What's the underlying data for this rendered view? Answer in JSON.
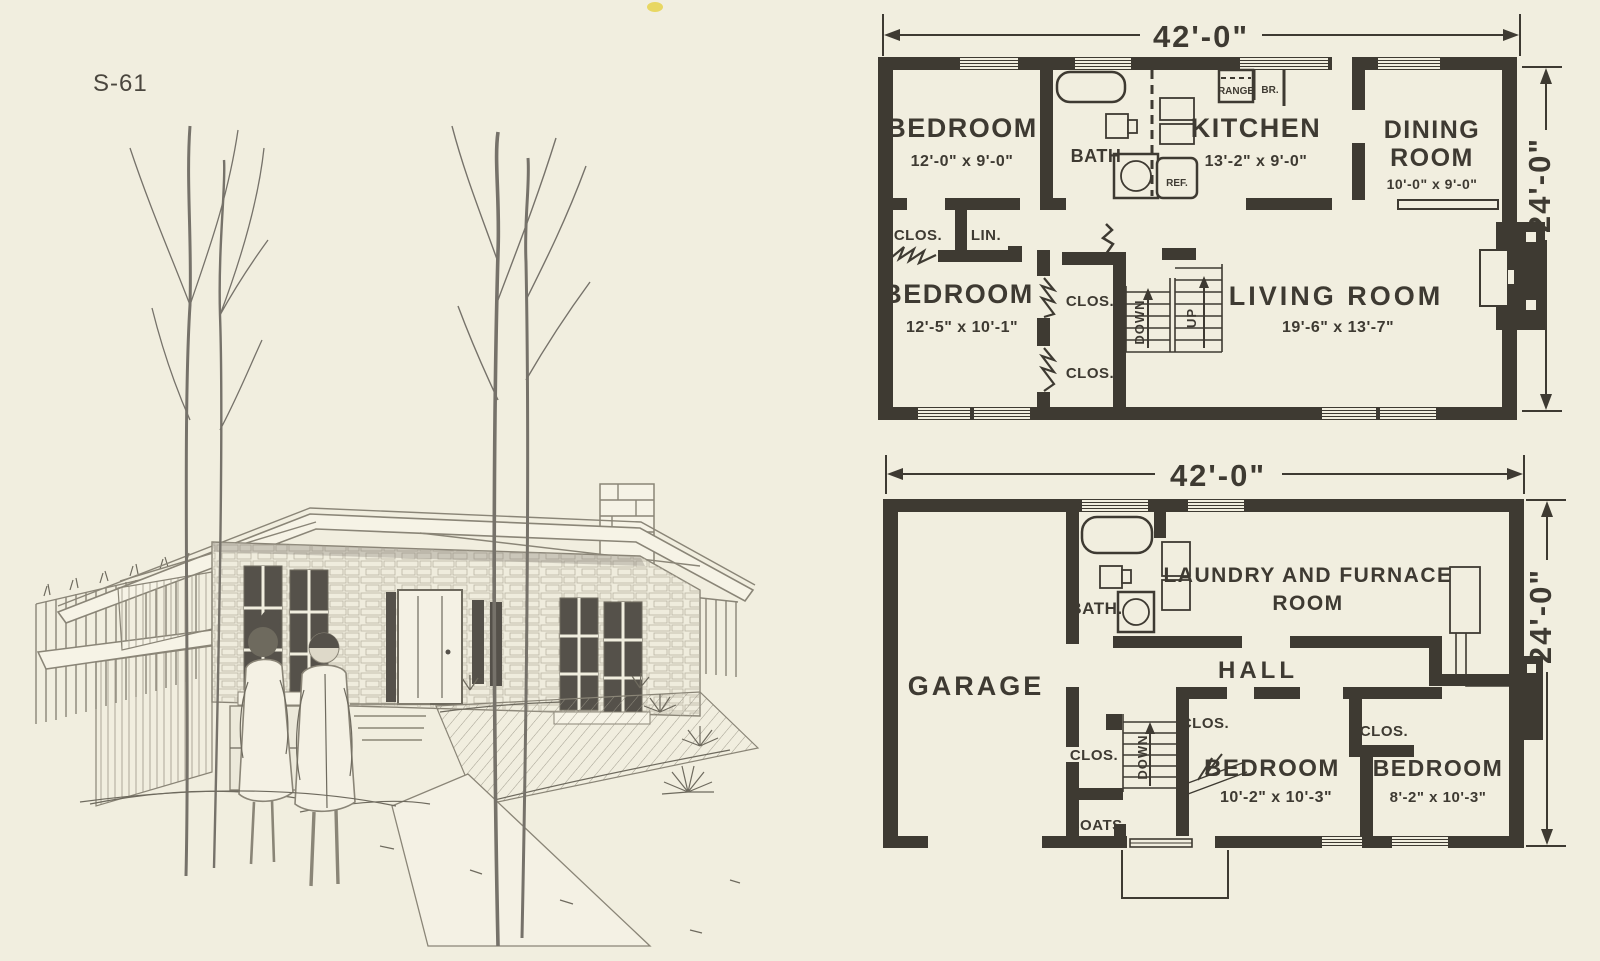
{
  "page": {
    "code": "S-61"
  },
  "colors": {
    "paper": "#f1eedf",
    "ink": "#3e3a32",
    "sketch": "#8a8577",
    "dark": "#55514a"
  },
  "illustration": {
    "caption": "pencil rendering of split-level stone house with couple walking toward entry"
  },
  "upper_plan": {
    "width_dim": "42'-0\"",
    "height_dim": "24'-0\"",
    "bedroom1": {
      "name": "BEDROOM",
      "dims": "12'-0\" x 9'-0\""
    },
    "bath": {
      "name": "BATH"
    },
    "kitchen": {
      "name": "KITCHEN",
      "dims": "13'-2\" x 9'-0\""
    },
    "dining": {
      "line1": "DINING",
      "line2": "ROOM",
      "dims": "10'-0\" x 9'-0\""
    },
    "bedroom2": {
      "name": "BEDROOM",
      "dims": "12'-5\" x 10'-1\""
    },
    "living": {
      "name": "LIVING ROOM",
      "dims": "19'-6\" x 13'-7\""
    },
    "labels": {
      "clos": "CLOS.",
      "lin": "LIN.",
      "down": "DOWN",
      "up": "UP",
      "range": "RANGE",
      "br": "BR.",
      "ref": "REF."
    }
  },
  "lower_plan": {
    "width_dim": "42'-0\"",
    "height_dim": "24'-0\"",
    "garage": {
      "name": "GARAGE"
    },
    "bath": {
      "name": "BATH."
    },
    "laundry": {
      "line1": "LAUNDRY AND FURNACE",
      "line2": "ROOM"
    },
    "hall": {
      "name": "HALL"
    },
    "bedroom1": {
      "name": "BEDROOM",
      "dims": "10'-2\" x 10'-3\""
    },
    "bedroom2": {
      "name": "BEDROOM",
      "dims": "8'-2\" x 10'-3\""
    },
    "labels": {
      "clos": "CLOS.",
      "coats": "COATS.",
      "down": "DOWN"
    }
  }
}
